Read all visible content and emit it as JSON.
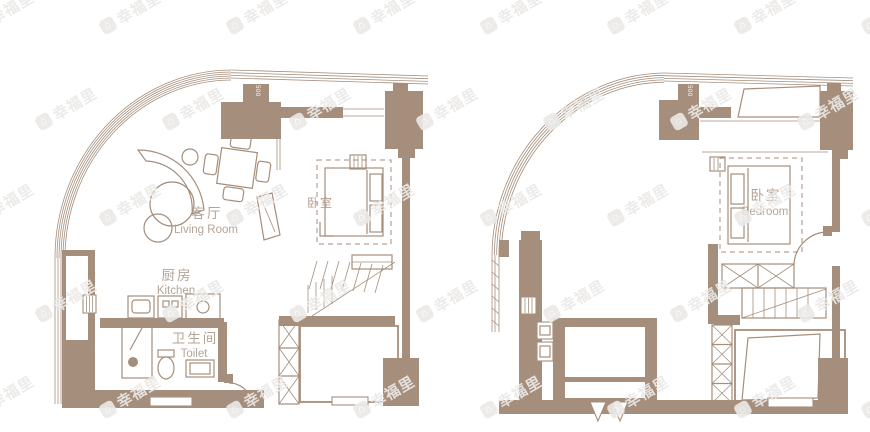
{
  "colors": {
    "wall": "#a58e7c",
    "label": "#b5a496",
    "wm": "#ebe9e7",
    "bg": "#ffffff"
  },
  "watermark": {
    "text": "幸福里",
    "icon": "home-logo-icon",
    "rotation_deg": -30,
    "rows": 5,
    "cols": 8,
    "dx": 127,
    "dy": 96,
    "stagger": 63,
    "start_x": -30,
    "start_y": 2
  },
  "plans": [
    {
      "id": "lower-level",
      "door_label": "1500",
      "rooms": {
        "living": {
          "zh": "客厅",
          "en": "Living Room"
        },
        "bedroom": {
          "zh": "卧室",
          "en": ""
        },
        "kitchen": {
          "zh": "厨房",
          "en": "Kitchen"
        },
        "toilet": {
          "zh": "卫生间",
          "en": "Toilet"
        }
      }
    },
    {
      "id": "upper-level",
      "door_label": "1500",
      "rooms": {
        "bedroom": {
          "zh": "卧室",
          "en": "Bedroom"
        }
      }
    }
  ]
}
